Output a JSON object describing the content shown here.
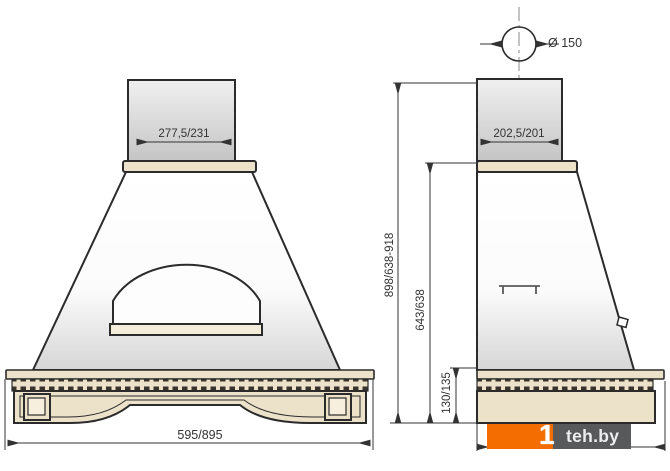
{
  "drawing": {
    "type": "kitchen-hood-dimension-drawing",
    "front_view": {
      "duct_width": "277,5/231",
      "overall_width": "595/895"
    },
    "side_view": {
      "flue_diameter": "Ø 150",
      "duct_depth": "202,5/201",
      "overall_height": "898/638-918",
      "body_height": "643/638",
      "cornice_height": "130/135"
    },
    "colors": {
      "line": "#2b2b2b",
      "dimension_line": "#333333",
      "wood_beige": "#ece1c9",
      "duct_gray": "#c9c9c9",
      "watermark_orange": "#f36d00",
      "watermark_gray": "#58595b"
    }
  },
  "watermark": {
    "mark": "1",
    "text": "teh.by"
  }
}
